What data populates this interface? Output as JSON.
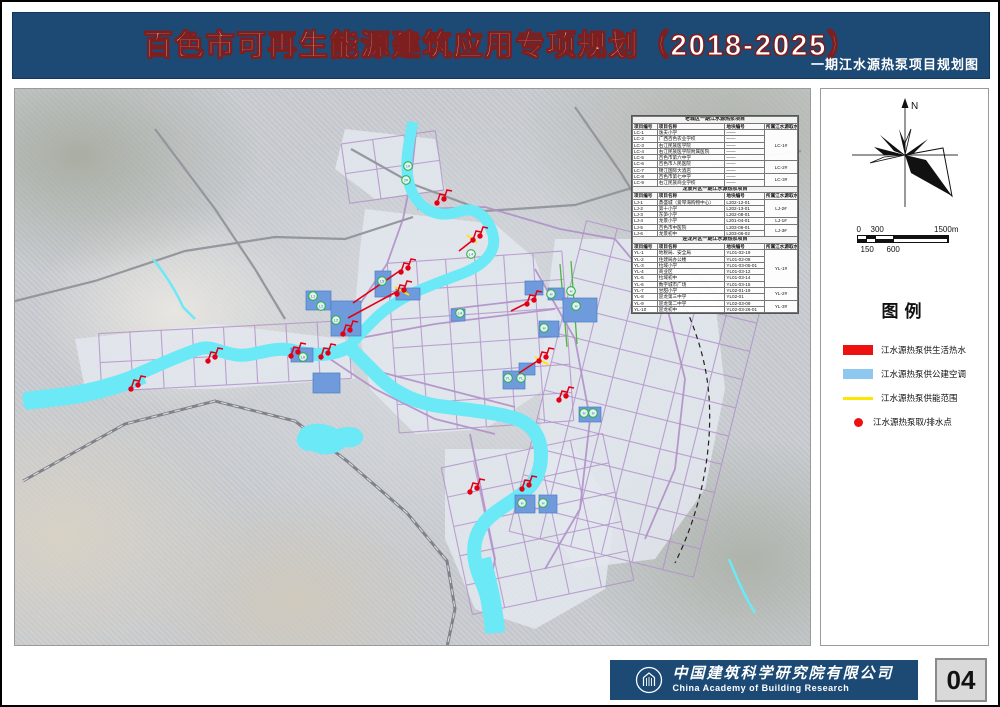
{
  "colors": {
    "header_blue": "#1c4a74",
    "title_stroke": "#7d1f1f",
    "river": "#6ce9f6",
    "patch": "#6f9bdd",
    "road_purple": "#b18fc9",
    "road_gray": "#90939a",
    "red": "#e30016",
    "yellow": "#ffe600",
    "badge_green": "#2eaf4e",
    "legend_blue": "#8ec7f0"
  },
  "header": {
    "title": "百色市可再生能源建筑应用专项规划（2018-2025）",
    "subtitle": "一期江水源热泵项目规划图"
  },
  "footer": {
    "company_cn": "中国建筑科学研究院有限公司",
    "company_en": "China Academy of Building Research",
    "page_number": "04"
  },
  "sidebar": {
    "north_label": "N",
    "scale": {
      "top": [
        "0",
        "300",
        "1500m"
      ],
      "bottom": [
        "150",
        "600"
      ]
    },
    "legend": {
      "title": "图例",
      "items": [
        {
          "type": "rect",
          "color": "#ee1111",
          "label": "江水源热泵供生活热水"
        },
        {
          "type": "rect",
          "color": "#8ec7f0",
          "label": "江水源热泵供公建空调"
        },
        {
          "type": "line",
          "color": "#ffe600",
          "label": "江水源热泵供能范围"
        },
        {
          "type": "dot",
          "color": "#ee1111",
          "label": "江水源热泵取/排水点"
        }
      ]
    }
  },
  "map": {
    "table": {
      "sections": [
        {
          "title": "老城区一期江水源热泵项目",
          "headers": [
            "项目编号",
            "项目名称",
            "地块编号",
            "所属江水源取水点"
          ],
          "rows": [
            {
              "id": "LC-1",
              "name": "逸夫小学",
              "plot": "——",
              "point": "LC-1#",
              "span": 5
            },
            {
              "id": "LC-2",
              "name": "广西百色农业学校",
              "plot": "——"
            },
            {
              "id": "LC-3",
              "name": "右江民族医学院",
              "plot": "——"
            },
            {
              "id": "LC-4",
              "name": "右江民族医学院附属医院",
              "plot": "——"
            },
            {
              "id": "LC-5",
              "name": "百色市第六中学",
              "plot": "——"
            },
            {
              "id": "LC-6",
              "name": "百色市人民医院",
              "plot": "——",
              "point": "LC-2#",
              "span": 2
            },
            {
              "id": "LC-7",
              "name": "锦江国际大酒店",
              "plot": "——"
            },
            {
              "id": "LC-8",
              "name": "百色市第七中学",
              "plot": "——",
              "point": "LC-3#",
              "span": 2
            },
            {
              "id": "LC-9",
              "name": "右江民族商业学校",
              "plot": "——"
            }
          ]
        },
        {
          "title": "龙景片区一期江水源热泵项目",
          "headers": [
            "项目编号",
            "项目名称",
            "地块编号",
            "所属江水源取水点"
          ],
          "rows": [
            {
              "id": "LJ-1",
              "name": "鼎盛城（爱琴海购物中心）",
              "plot": "L202-12-01",
              "point": "LJ-2#",
              "span": 3
            },
            {
              "id": "LJ-2",
              "name": "第十小学",
              "plot": "L202-13-01"
            },
            {
              "id": "LJ-3",
              "name": "东笋小学",
              "plot": "L202-08-01"
            },
            {
              "id": "LJ-4",
              "name": "龙景小学",
              "plot": "L201-04-01",
              "point": "LJ-1#",
              "span": 1
            },
            {
              "id": "LJ-5",
              "name": "百色市中医院",
              "plot": "L203-06-01",
              "point": "LJ-3#",
              "span": 2
            },
            {
              "id": "LJ-6",
              "name": "龙景初中",
              "plot": "L203-06-02"
            }
          ]
        },
        {
          "title": "迎龙片区一期江水源热泵项目",
          "headers": [
            "项目编号",
            "项目名称",
            "地块编号",
            "所属江水源取水点"
          ],
          "rows": [
            {
              "id": "YL-1",
              "name": "地税局、安全局",
              "plot": "YL01-02-19",
              "point": "YL-1#",
              "span": 6
            },
            {
              "id": "YL-2",
              "name": "住建局办公楼",
              "plot": "YL01-02-08"
            },
            {
              "id": "YL-3",
              "name": "拉域小学",
              "plot": "YL01-03-05-01"
            },
            {
              "id": "YL-4",
              "name": "商业区",
              "plot": "YL01-03-12"
            },
            {
              "id": "YL-5",
              "name": "拉域初中",
              "plot": "YL01-03-14"
            },
            {
              "id": "YL-6",
              "name": "数字城市广场",
              "plot": "YL01-03-15"
            },
            {
              "id": "YL-7",
              "name": "甘甜小学",
              "plot": "YL02-01-19",
              "point": "YL-2#",
              "span": 2
            },
            {
              "id": "YL-8",
              "name": "迎龙第三中学",
              "plot": "YL02-01"
            },
            {
              "id": "YL-9",
              "name": "迎龙第二中学",
              "plot": "YL02-03-09",
              "point": "YL-3#",
              "span": 2
            },
            {
              "id": "YL-10",
              "name": "迎龙初中",
              "plot": "YL02-03-26-01"
            }
          ]
        }
      ]
    },
    "geometry": {
      "urban": [
        "350,120 480,135 520,170 545,240 530,300 470,340 400,345 355,300 340,220 345,160",
        "540,150 640,150 700,210 710,300 690,400 640,470 560,480 530,420 525,330 530,230",
        "60,250 200,235 330,250 340,290 200,300 70,300",
        "430,360 560,360 600,420 590,500 520,540 460,520 430,450",
        "330,40 420,50 430,100 360,110 320,80"
      ],
      "grids": [
        {
          "x": 378,
          "y": 168,
          "w": 175,
          "h": 170,
          "cols": 6,
          "rows": 6,
          "rot": -4
        },
        {
          "x": 530,
          "y": 150,
          "w": 190,
          "h": 320,
          "cols": 6,
          "rows": 11,
          "rot": 14
        },
        {
          "x": 85,
          "y": 238,
          "w": 250,
          "h": 58,
          "cols": 8,
          "rows": 2,
          "rot": -3
        },
        {
          "x": 440,
          "y": 360,
          "w": 165,
          "h": 150,
          "cols": 5,
          "rows": 5,
          "rot": -12
        },
        {
          "x": 330,
          "y": 48,
          "w": 95,
          "h": 60,
          "cols": 3,
          "rows": 2,
          "rot": -8
        }
      ],
      "gray_roads": [
        "M0,212 L80,192 170,162 260,148 330,150 398,128",
        "M336,60 L400,96 470,122 560,116 640,92 730,70 786,62",
        "M560,18 L606,84 642,142",
        "M140,40 L200,120 240,180 270,230",
        "M642,142 L700,205"
      ],
      "rail": "M8,392 L110,335 200,312 280,332 332,372 392,424 432,472 440,520 432,558",
      "purple_roads": [
        "M402,34 L396,90 388,130 372,175 345,215 318,245",
        "M402,120 L470,118 545,140 600,150",
        "M340,250 L420,235 500,225 540,220",
        "M300,260 L360,300 420,330 480,345",
        "M520,180 L560,250 575,330 565,420 530,480",
        "M600,150 L650,210 670,290 660,380 630,450",
        "M436,220 L520,210",
        "M455,345 L470,420 480,470 470,520",
        "M350,279 L430,300 500,318"
      ],
      "green_roads": [
        "M545,175 L552,258",
        "M556,172 L562,255"
      ],
      "boundary": "M630,140 C664,200 690,250 694,308 C698,366 684,426 660,474",
      "rivers": [
        {
          "d": "M398,33 C392,60 388,85 398,105 C408,122 424,130 446,122 C462,117 474,130 478,146 C482,162 470,176 446,185 C414,197 386,206 362,228 C350,240 340,250 334,258",
          "w": 11
        },
        {
          "d": "M334,258 C318,266 300,268 280,262 C258,256 240,268 222,266 C206,264 196,256 184,260 C160,268 140,278 116,288 C88,300 60,306 40,308 L8,312",
          "w": 13
        },
        {
          "d": "M128,286 C100,298 66,306 44,308 L10,312",
          "w": 18
        },
        {
          "d": "M334,258 C344,268 352,276 364,288 C380,304 398,312 418,316 C440,320 478,322 502,330 C518,336 526,348 526,366 C526,386 518,398 500,410 C482,422 468,430 462,446 C456,462 460,478 468,496 C474,512 478,526 480,544",
          "w": 14
        },
        {
          "d": "M466,470 C472,494 478,516 480,544",
          "w": 20
        }
      ],
      "lakes": [
        "M286,340 C296,332 312,334 322,340 C334,336 346,338 348,346 C350,354 340,360 330,358 C322,366 306,368 298,362 C288,364 280,356 282,348 Z"
      ],
      "streams": [
        "M138,170 C150,185 160,200 168,218 L180,230",
        "M714,470 C722,490 730,508 740,524"
      ],
      "patches": [
        [
          291,
          202,
          25,
          19
        ],
        [
          316,
          212,
          30,
          35
        ],
        [
          360,
          182,
          16,
          26
        ],
        [
          381,
          199,
          24,
          12
        ],
        [
          298,
          284,
          27,
          20
        ],
        [
          276,
          259,
          22,
          14
        ],
        [
          510,
          192,
          18,
          14
        ],
        [
          533,
          199,
          16,
          12
        ],
        [
          548,
          209,
          34,
          24
        ],
        [
          524,
          232,
          20,
          16
        ],
        [
          488,
          282,
          22,
          18
        ],
        [
          504,
          274,
          16,
          12
        ],
        [
          564,
          318,
          22,
          15
        ],
        [
          500,
          406,
          20,
          18
        ],
        [
          524,
          406,
          18,
          18
        ],
        [
          436,
          220,
          14,
          12
        ]
      ],
      "red_lines": [
        "M386,181 L338,214",
        "M383,202 L333,229",
        "M524,271 L504,284",
        "M512,214 L496,222",
        "M458,151 L444,162"
      ],
      "yellow_lines": [
        "M520,268 L534,276",
        "M380,198 L394,206",
        "M452,146 L462,154"
      ],
      "markers": [
        [
          422,
          114
        ],
        [
          458,
          151
        ],
        [
          386,
          183
        ],
        [
          382,
          205
        ],
        [
          328,
          245
        ],
        [
          306,
          268
        ],
        [
          276,
          267
        ],
        [
          193,
          272
        ],
        [
          116,
          300
        ],
        [
          524,
          272
        ],
        [
          512,
          215
        ],
        [
          544,
          311
        ],
        [
          507,
          400
        ],
        [
          455,
          403
        ]
      ],
      "badges": [
        [
          393,
          77,
          "1#"
        ],
        [
          391,
          91,
          "2#"
        ],
        [
          456,
          165,
          "L4"
        ],
        [
          298,
          207,
          "L1"
        ],
        [
          306,
          217,
          "L2"
        ],
        [
          321,
          231,
          "L2"
        ],
        [
          367,
          192,
          "L5"
        ],
        [
          445,
          224,
          "L4"
        ],
        [
          536,
          205,
          "H"
        ],
        [
          556,
          202,
          "H"
        ],
        [
          561,
          217,
          "H"
        ],
        [
          529,
          239,
          "H"
        ],
        [
          493,
          289,
          "YL"
        ],
        [
          506,
          289,
          "YL"
        ],
        [
          569,
          324,
          "H"
        ],
        [
          578,
          324,
          "H"
        ],
        [
          507,
          414,
          "H"
        ],
        [
          528,
          414,
          "H"
        ],
        [
          288,
          268,
          "L6"
        ]
      ]
    }
  }
}
